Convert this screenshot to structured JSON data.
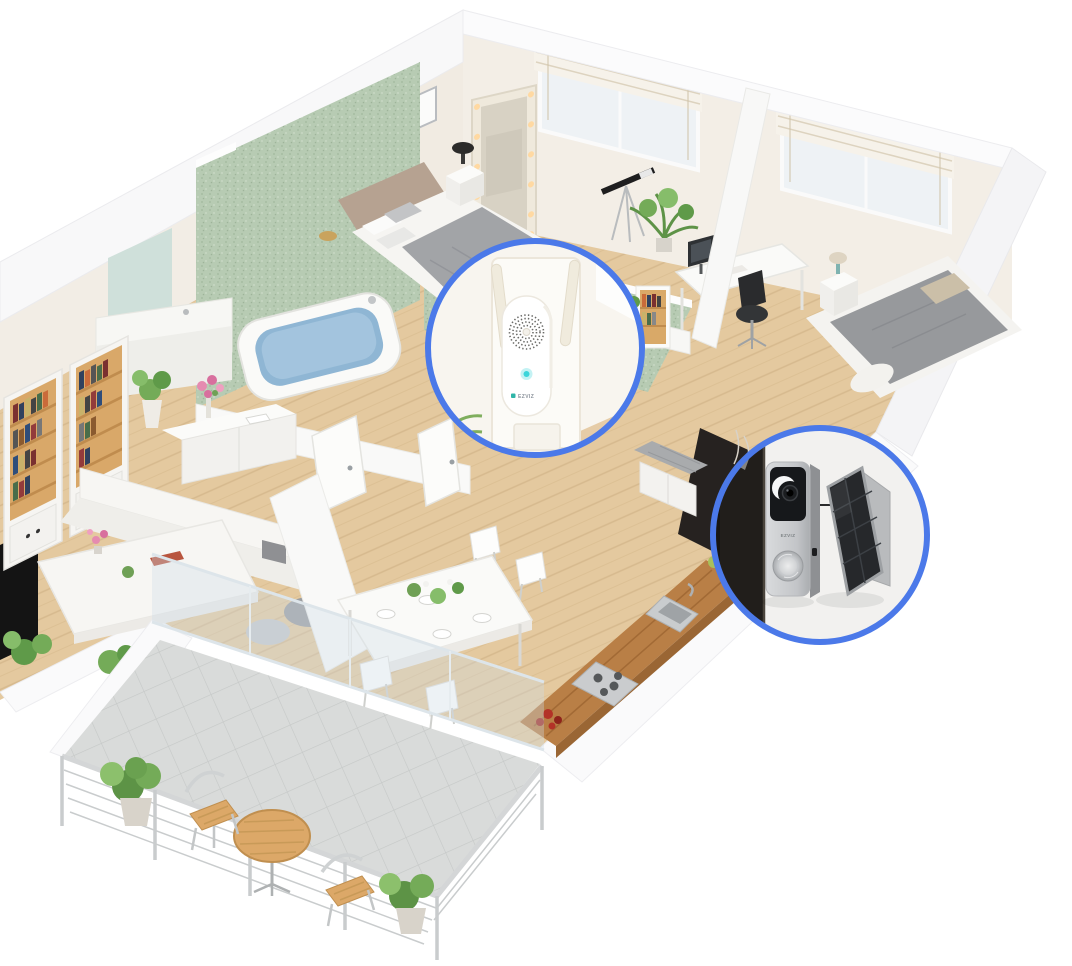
{
  "scene": {
    "description": "Isometric 3D cutaway apartment render showing smart doorbell kit placement",
    "rooms": [
      "master-bedroom",
      "bathroom",
      "study-nook",
      "second-bedroom",
      "living-room",
      "dining-area",
      "kitchen",
      "entrance-hall",
      "balcony"
    ],
    "furniture": [
      "double-bed",
      "vanity-mirror-with-lights",
      "picture-frames",
      "bathtub",
      "sink-vanity",
      "bookshelves",
      "sideboard-with-flowers",
      "coffee-table",
      "sofa",
      "dining-table-with-chairs",
      "kitchen-counter-sink-hob",
      "desk-with-monitor",
      "office-chair",
      "telescope",
      "single-bed",
      "nightstand-lamp",
      "shoe-bench",
      "bistro-table-and-chairs",
      "potted-plants",
      "roman-blind-windows",
      "glass-balcony-wall",
      "metal-railing"
    ]
  },
  "callouts": {
    "ring_color": "#4b79e9",
    "chime": {
      "device": "wireless-smart-chime",
      "label": "EZVIZ",
      "led_color": "#3bd5da",
      "parts": [
        "wall-plate",
        "dual-antennas",
        "speaker-grille",
        "status-led",
        "brand-logo",
        "power-outlet"
      ]
    },
    "doorbell": {
      "device": "battery-video-doorbell",
      "label": "EZVIZ",
      "accessory": "solar-charging-panel",
      "parts": [
        "camera-lens",
        "brand-logo",
        "ring-button",
        "solar-panel",
        "mount-bracket",
        "door-frame"
      ]
    }
  },
  "palette": {
    "accent": "#4b79e9",
    "led": "#3bd5da",
    "tileGreen": "#b7cbb3",
    "wood": "#e4c99f",
    "woodDark": "#b97f46",
    "wallWhite": "#f5f4f2",
    "wallWarm": "#f3eee6",
    "textileGray": "#9b9da0",
    "plantGreen": "#6f9f52",
    "metalSilver": "#c6c8ca",
    "doorDark": "#262220"
  }
}
